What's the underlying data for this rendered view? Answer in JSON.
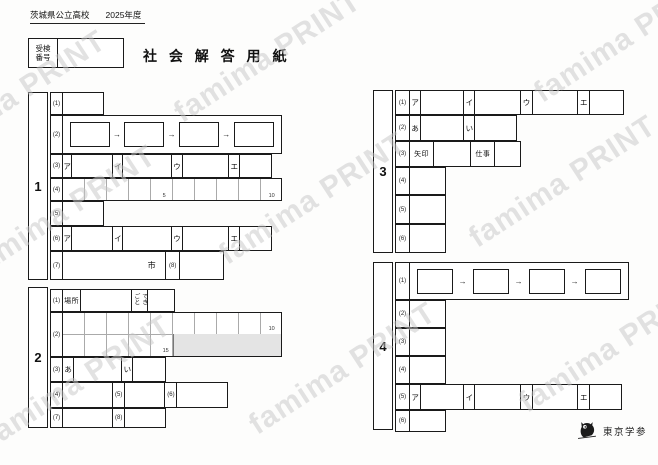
{
  "header": {
    "school": "茨城県公立高校",
    "year": "2025年度",
    "examinee_line1": "受検",
    "examinee_line2": "番号",
    "title": "社 会 解 答 用 紙"
  },
  "watermark": {
    "text": "famima PRINT"
  },
  "sections": {
    "s1": "1",
    "s2": "2",
    "s3": "3",
    "s4": "4"
  },
  "q": {
    "n1": "(1)",
    "n2": "(2)",
    "n3": "(3)",
    "n4": "(4)",
    "n5": "(5)",
    "n6": "(6)",
    "n7": "(7)",
    "n8": "(8)"
  },
  "labels": {
    "katakana_a": "ア",
    "katakana_i": "イ",
    "katakana_u": "ウ",
    "katakana_e": "エ",
    "hiragana_a": "あ",
    "hiragana_i": "い",
    "arrow": "→",
    "place": "場所",
    "event": "できごと",
    "arrow_word": "矢印",
    "work": "仕事",
    "city": "市"
  },
  "char_marks": {
    "five": "5",
    "ten": "10",
    "fifteen": "15"
  },
  "publisher": {
    "name": "東京学参",
    "logo": "owl-icon"
  },
  "colors": {
    "line": "#1a1a1a",
    "light_line": "#aaaaaa",
    "shaded": "#e4e4e4",
    "watermark": "#c7c7c7"
  }
}
